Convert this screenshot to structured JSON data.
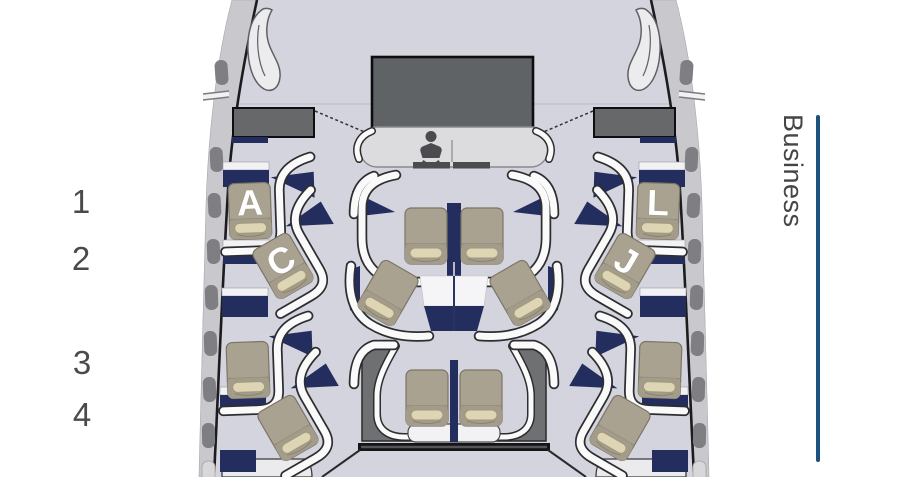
{
  "seat_map": {
    "cabin_class": {
      "label": "Business",
      "line_color": "#1b5280"
    },
    "row_labels": [
      "1",
      "2",
      "3",
      "4"
    ],
    "seats": {
      "labeled": [
        {
          "id": "1A",
          "letter": "A"
        },
        {
          "id": "2C",
          "letter": "C"
        },
        {
          "id": "2J",
          "letter": "J"
        },
        {
          "id": "1L",
          "letter": "L"
        }
      ],
      "unlabeled_positions": [
        "row1-center-left",
        "row1-center-right",
        "row2-center-left",
        "row2-center-right",
        "row3-window-left",
        "row3-window-right",
        "row3-center-left",
        "row3-center-right",
        "row4-window-left",
        "row4-window-right"
      ]
    },
    "amenities": [
      {
        "icon": "baby-care-icon",
        "location": "front-center-console"
      }
    ],
    "palette": {
      "floor": "#d4d4de",
      "wall": "#c9c9cd",
      "window": "#7e7e83",
      "monument_dark": "#606366",
      "galley": "#66686a",
      "navy_accent": "#232d5e",
      "seat": "#aaa290",
      "seat_strip": "#ded5b5",
      "shell_white": "#fafafb",
      "rear_shell_dark": "#6e7072",
      "class_line_blue": "#1b5280"
    }
  }
}
